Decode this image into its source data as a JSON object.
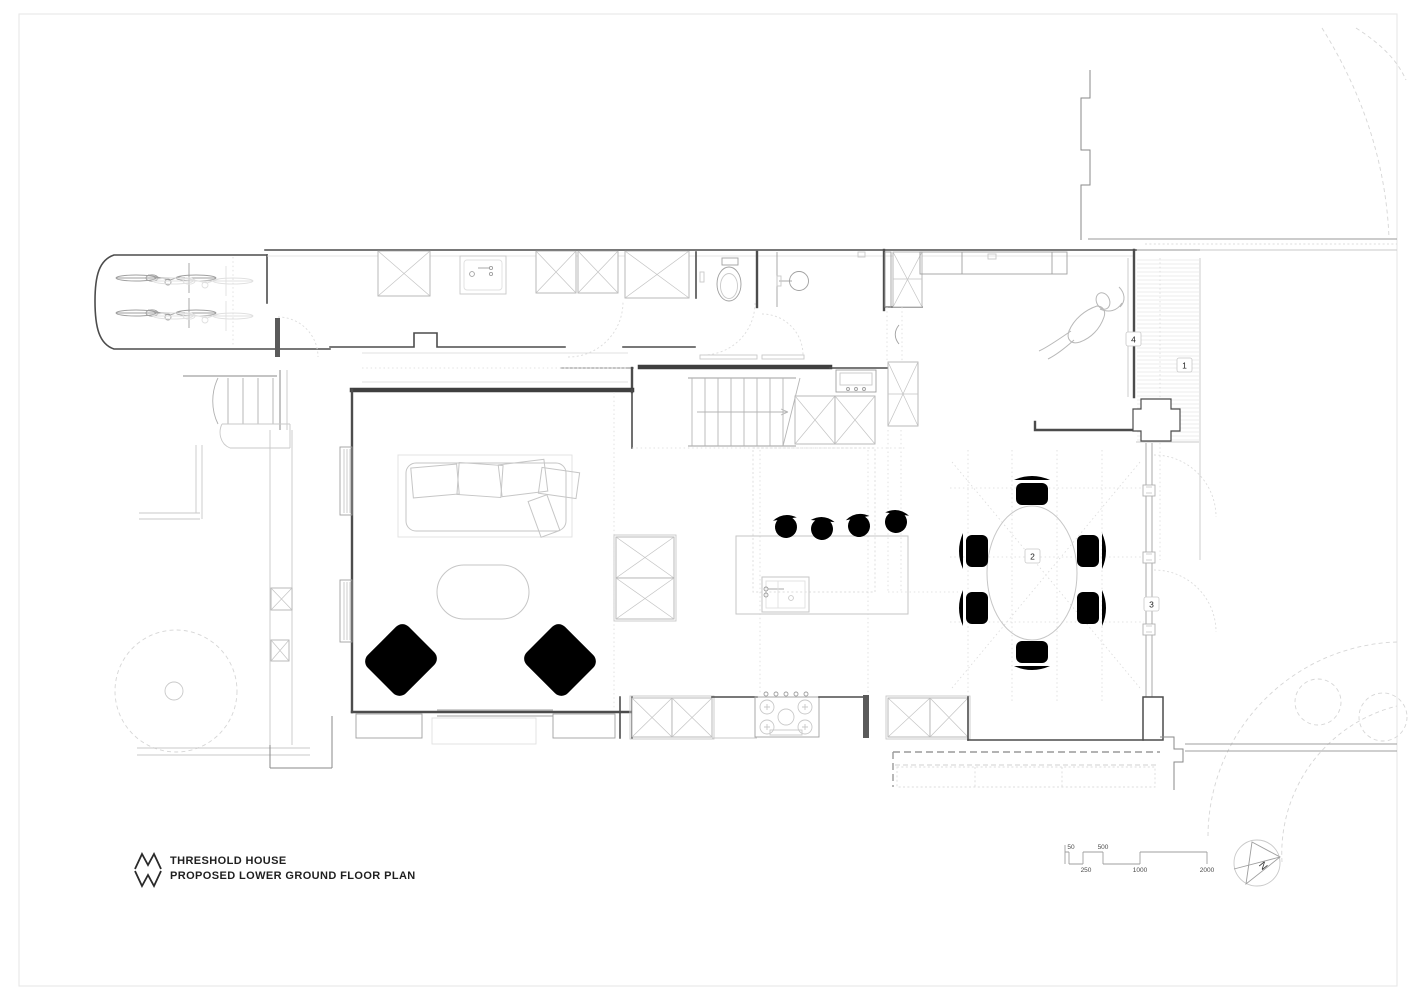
{
  "title_block": {
    "project_name": "THRESHOLD HOUSE",
    "drawing_name": "PROPOSED LOWER GROUND FLOOR PLAN",
    "logo": "mw-monogram"
  },
  "plan": {
    "reference_markers": {
      "m1": "1",
      "m2": "2",
      "m3": "3",
      "m4": "4"
    }
  },
  "scale_bar": {
    "labels_above": [
      "50",
      "500"
    ],
    "labels_below": [
      "250",
      "1000",
      "2000"
    ]
  },
  "north_arrow": {
    "label": "N"
  },
  "colors": {
    "background": "#ffffff",
    "page_border": "#e9e9e9",
    "walls": "#474747",
    "fixtures": "#9f9f9f",
    "furniture": "#c6c6c6",
    "landscape_dashed": "#d6d6d6",
    "text": "#1d1d1d"
  }
}
